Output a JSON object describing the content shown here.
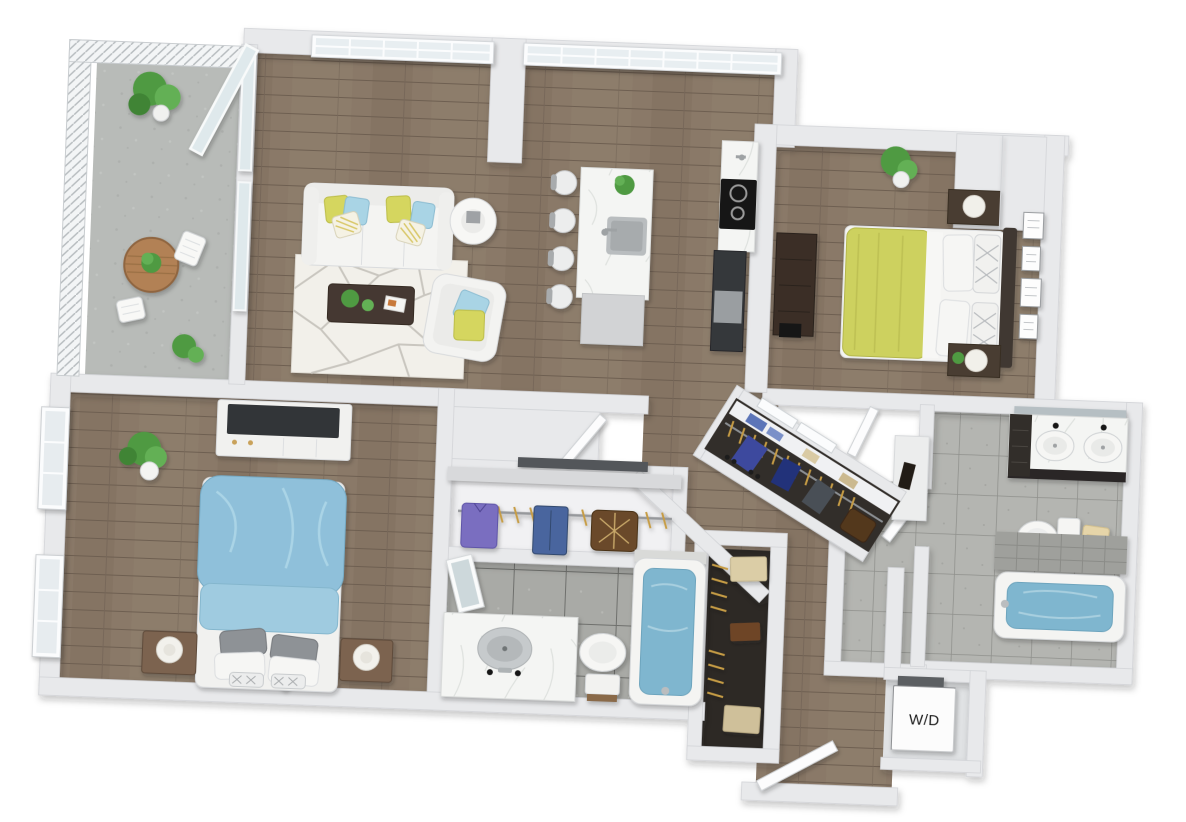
{
  "labels": {
    "washer_dryer": "W/D"
  },
  "palette": {
    "wall": "#e8e9eb",
    "wall_edge": "#d2d4d7",
    "wood_floor": "#8a7968",
    "concrete": "#b8bbb8",
    "tile": "#b4b5b1",
    "tile_dark": "#a9aaa6",
    "marble": "#f4f5f3",
    "accent_yellow": "#d5d65e",
    "accent_blue": "#a9d4e5",
    "duvet_yellow": "#cdd15e",
    "duvet_blue": "#8fc0da",
    "water": "#7fb6cf",
    "plant": "#4f9a43",
    "dark_wood": "#4a3c30",
    "appliance_black": "#141414",
    "rug": "#f2f0ea"
  },
  "scene": {
    "view": "3d-top-down-apartment-floor-plan",
    "rooms": [
      {
        "name": "balcony",
        "furniture": [
          "railing",
          "round-wood-table",
          "potted-plant",
          "folding-chairs"
        ]
      },
      {
        "name": "living-room",
        "furniture": [
          "sofa",
          "accent-pillows",
          "round-side-table",
          "geometric-rug",
          "coffee-table",
          "armchair"
        ]
      },
      {
        "name": "kitchen",
        "furniture": [
          "marble-island",
          "island-sink",
          "bar-stools",
          "cooktop",
          "oven",
          "counter"
        ]
      },
      {
        "name": "master-bedroom",
        "furniture": [
          "double-bed-yellow-duvet",
          "nightstands",
          "lamps",
          "dresser",
          "wall-frames",
          "plant",
          "built-in-closet"
        ]
      },
      {
        "name": "master-bathroom",
        "furniture": [
          "double-vanity",
          "mirror",
          "toilet",
          "towel",
          "bathtub"
        ]
      },
      {
        "name": "walk-in-closet",
        "furniture": [
          "hanging-clothes",
          "shelf-stacks",
          "shoes",
          "suitcase",
          "double-doors"
        ]
      },
      {
        "name": "bedroom-2",
        "furniture": [
          "double-bed-blue-duvet",
          "nightstands",
          "sphere-lamps",
          "media-console",
          "plant",
          "windows"
        ]
      },
      {
        "name": "closet-2",
        "furniture": [
          "hanging-shirt",
          "jeans",
          "monogram-bag",
          "gold-hangers"
        ]
      },
      {
        "name": "bathroom-2",
        "furniture": [
          "marble-vanity",
          "round-sink",
          "leaning-mirror",
          "toilet",
          "bathtub"
        ]
      },
      {
        "name": "linen-closet",
        "furniture": [
          "gold-hangers",
          "storage-boxes"
        ]
      },
      {
        "name": "entry",
        "furniture": [
          "open-entry-door"
        ]
      },
      {
        "name": "laundry-closet",
        "furniture": [
          "stacked-washer-dryer"
        ]
      }
    ]
  }
}
